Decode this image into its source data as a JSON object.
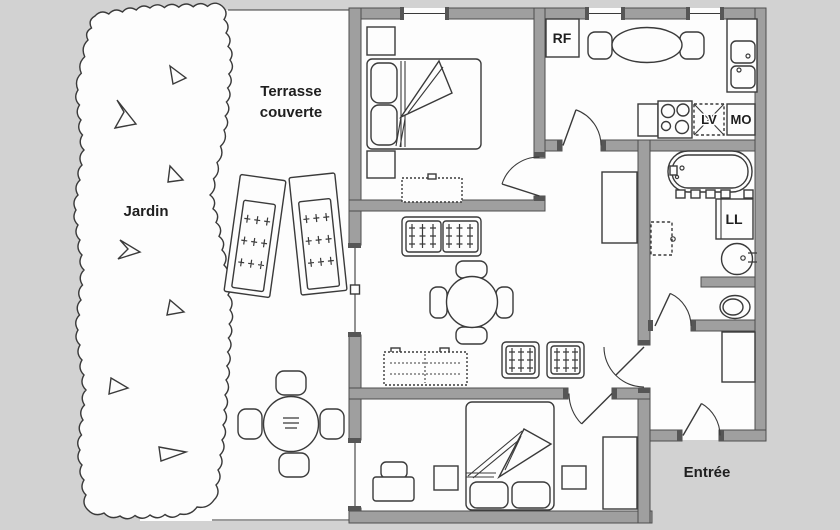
{
  "labels": {
    "garden": "Jardin",
    "terrace_line1": "Terrasse",
    "terrace_line2": "couverte",
    "entrance": "Entrée",
    "fridge": "RF",
    "dishwasher": "LV",
    "microwave": "MO",
    "washing_machine": "LL"
  },
  "colors": {
    "background": "#d2d2d2",
    "paper": "#fdfdfd",
    "wall": "#9f9f9f",
    "wall_edge": "#4d4d4d",
    "line": "#3a3a3a",
    "text": "#1f1f1f"
  }
}
